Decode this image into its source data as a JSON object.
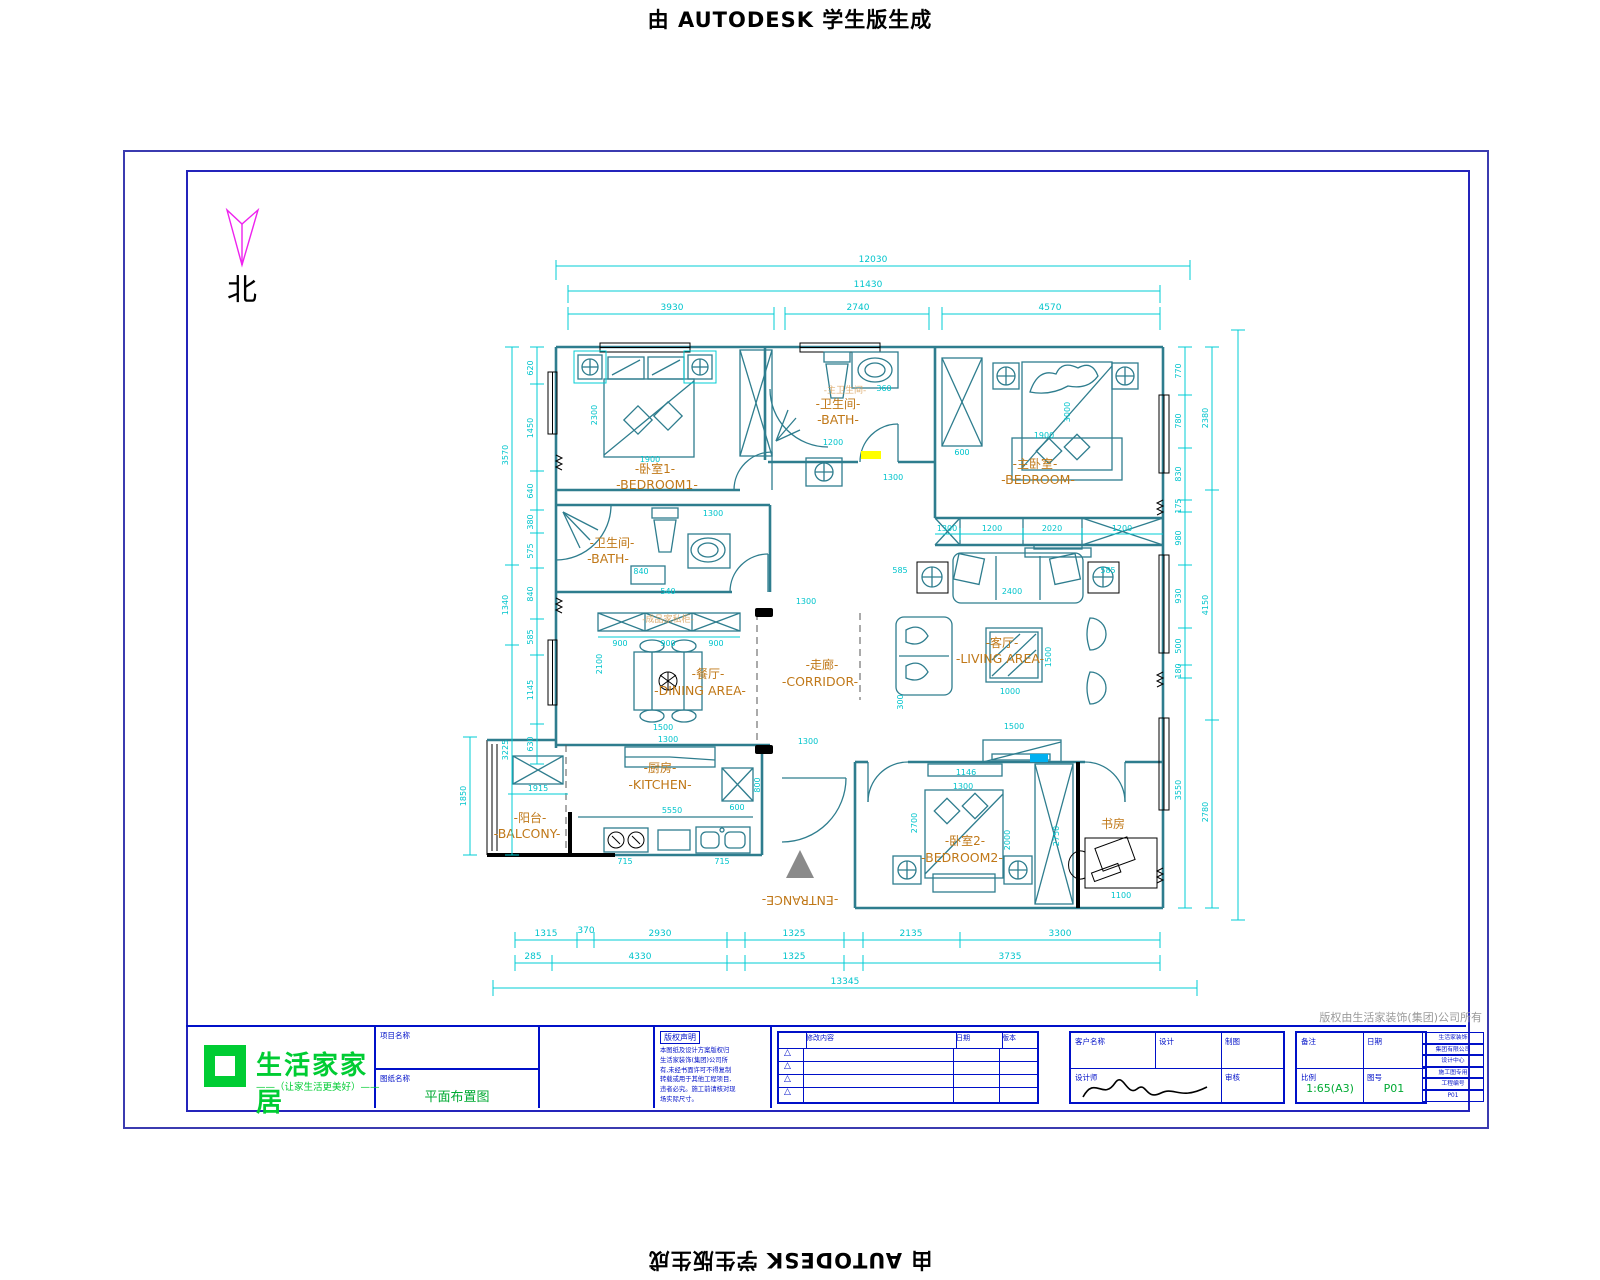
{
  "watermark": {
    "text": "由 AUTODESK 学生版生成"
  },
  "north": {
    "label": "北"
  },
  "rooms": [
    {
      "zh": "-卧室1-",
      "en": "-BEDROOM1-"
    },
    {
      "zh": "-卫生间-",
      "en": "-BATH-"
    },
    {
      "zh": "-主卧室-",
      "en": "-BEDROOM-"
    },
    {
      "zh": "-卫生间-",
      "en": "-BATH-"
    },
    {
      "zh": "-餐厅-",
      "en": "-DINING AREA-"
    },
    {
      "zh": "-走廊-",
      "en": "-CORRIDOR-"
    },
    {
      "zh": "-客厅-",
      "en": "-LIVING AREA-"
    },
    {
      "zh": "-厨房-",
      "en": "-KITCHEN-"
    },
    {
      "zh": "-阳台-",
      "en": "-BALCONY-"
    },
    {
      "zh": "-卧室2-",
      "en": "-BEDROOM2-"
    },
    {
      "zh": "书房",
      "en": ""
    },
    {
      "zh": "",
      "en": "-ENTRANCE-"
    }
  ],
  "ghosts": [
    "-主卫生间-",
    "-成品家私柜-"
  ],
  "dims": {
    "top": [
      "12030",
      "11430",
      "3930",
      "2740",
      "4570"
    ],
    "bottom1": [
      "1315",
      "370",
      "2930",
      "1325",
      "2135",
      "3300"
    ],
    "bottom2": [
      "285",
      "4330",
      "1325",
      "3735"
    ],
    "bottom_total": "13345",
    "left1": [
      "620",
      "1450",
      "640",
      "380",
      "575",
      "840",
      "585",
      "1145",
      "630"
    ],
    "left2": [
      "3570",
      "1340",
      "3225"
    ],
    "left3": [
      "1850",
      "1915"
    ],
    "right1": [
      "770",
      "780",
      "830",
      "175",
      "980",
      "930",
      "500",
      "180",
      "3550"
    ],
    "right2": [
      "2380",
      "4150",
      "2780"
    ],
    "closet_row": [
      "1300",
      "1200",
      "2020",
      "1200"
    ],
    "wardrobe_row": [
      "900",
      "900",
      "900"
    ],
    "interior": [
      "1900",
      "2300",
      "1200",
      "360",
      "840",
      "540",
      "3000",
      "1900",
      "600",
      "2100",
      "1500",
      "1300",
      "1300",
      "2400",
      "585",
      "585",
      "1500",
      "1000",
      "300",
      "1500",
      "5550",
      "715",
      "715",
      "800",
      "600",
      "2700",
      "2000",
      "1300",
      "1146",
      "2750",
      "1100",
      "1300",
      "1300",
      "1300"
    ]
  },
  "copyright_note": "版权由生活家装饰(集团)公司所有",
  "title_block": {
    "logo": {
      "name": "生活家家居",
      "tagline": "——（让家生活更美好）——"
    },
    "fields": {
      "project_label": "项目名称",
      "drawing_label": "图纸名称",
      "drawing_name": "平面布置图",
      "client_label": "客户名称",
      "design_label": "设计",
      "draft_label": "制图",
      "designer_label": "设计师",
      "audit_label": "审核",
      "date_label": "日期",
      "note_label": "备注",
      "scale_label": "比例",
      "scale_value": "1:65(A3)",
      "sheet_label": "图号",
      "sheet_value": "P01"
    },
    "notice": {
      "header": "版权声明",
      "lines": [
        "本图纸及设计方案版权归",
        "生活家装饰(集团)公司所",
        "有,未经书面许可不得复制",
        "转载或用于其他工程项目,",
        "违者必究。施工前请核对现",
        "场实际尺寸。"
      ]
    },
    "revisions": {
      "col_desc": "修改内容",
      "col_date": "日期",
      "col_ver": "版本"
    },
    "side_stack": [
      "生活家装饰",
      "集团有限公司",
      "设计中心",
      "施工图专用",
      "工程编号",
      "P01"
    ]
  }
}
